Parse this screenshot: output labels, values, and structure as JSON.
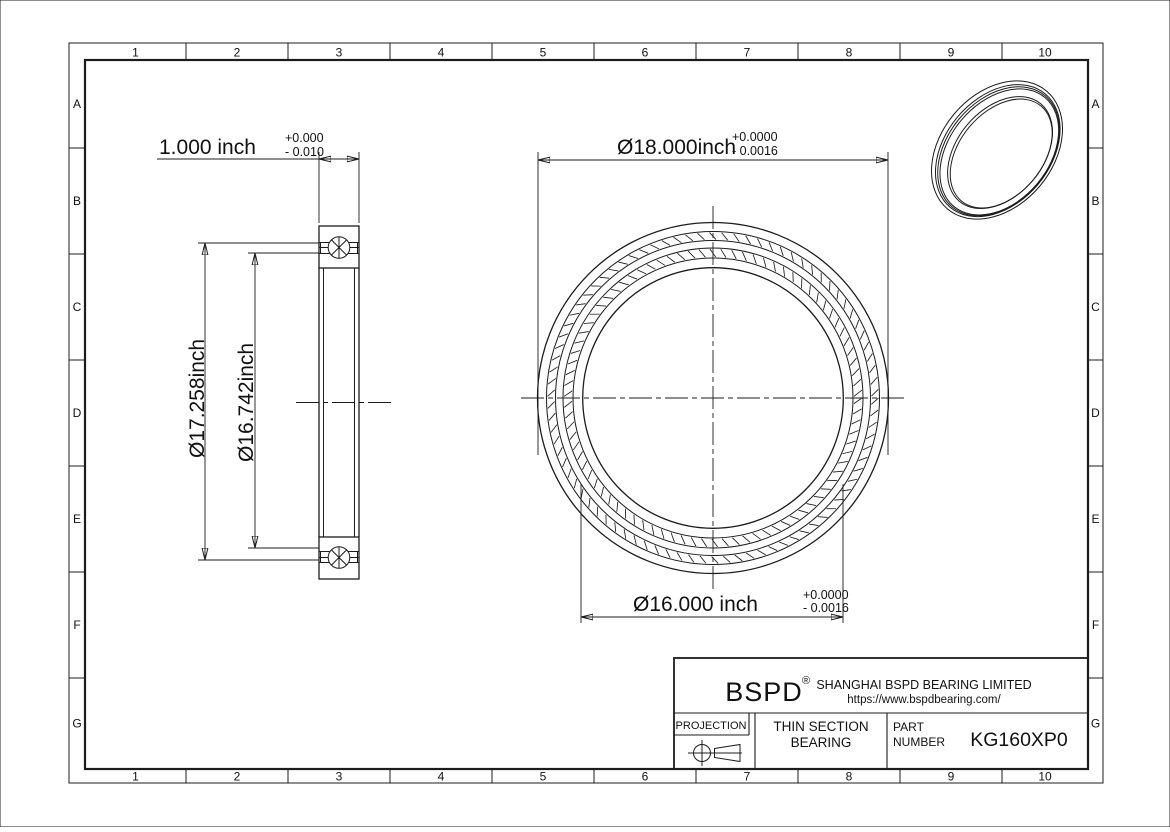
{
  "sheet": {
    "background": "#ffffff",
    "line_color": "#1c1c1c"
  },
  "grid": {
    "columns": [
      "1",
      "2",
      "3",
      "4",
      "5",
      "6",
      "7",
      "8",
      "9",
      "10"
    ],
    "rows": [
      "A",
      "B",
      "C",
      "D",
      "E",
      "F",
      "G"
    ]
  },
  "dimensions": {
    "width": {
      "text": "1.000 inch",
      "tol_plus": "+0.000",
      "tol_minus": "- 0.010"
    },
    "outer_diameter": {
      "text": "Ø18.000inch",
      "tol_plus": "+0.0000",
      "tol_minus": "- 0.0016"
    },
    "bore_diameter": {
      "text": "Ø16.000 inch",
      "tol_plus": "+0.0000",
      "tol_minus": "- 0.0016"
    },
    "outer_race": {
      "text": "Ø17.258inch"
    },
    "inner_race": {
      "text": "Ø16.742inch"
    }
  },
  "title_block": {
    "logo": "BSPD",
    "registered": "®",
    "company": "SHANGHAI BSPD BEARING LIMITED",
    "website": "https://www.bspdbearing.com/",
    "projection_label": "PROJECTION",
    "product": {
      "line1": "THIN SECTION",
      "line2": "BEARING"
    },
    "part": {
      "label_line1": "PART",
      "label_line2": "NUMBER",
      "number": "KG160XP0"
    }
  }
}
